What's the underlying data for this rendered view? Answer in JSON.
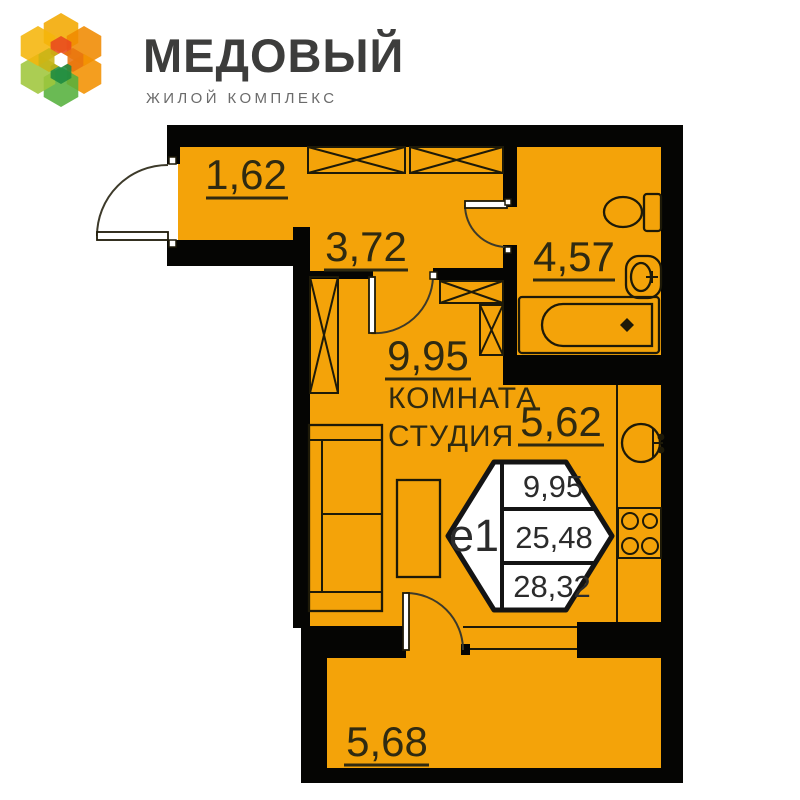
{
  "brand": {
    "name": "МЕДОВЫЙ",
    "tagline": "ЖИЛОЙ КОМПЛЕКС",
    "name_color": "#3D3D3C",
    "tagline_color": "#6B6B6B",
    "petal_colors": [
      "#F2A900",
      "#F08A00",
      "#F29100",
      "#55B03C",
      "#9FC63B",
      "#F5B50A",
      "#E8491F",
      "#E8740F",
      "#1D8A40",
      "#C8B415",
      "#FFFFFF"
    ]
  },
  "plan": {
    "colors": {
      "floor": "#F4A309",
      "walls": "#050503",
      "ink": "#2F2A11",
      "badge_fill": "#FFFFFF",
      "badge_stroke": "#141414"
    },
    "areas": {
      "entry": "1,62",
      "hallway": "3,72",
      "bathroom": "4,57",
      "room": "9,95",
      "kitchen": "5,62",
      "balcony": "5,68"
    },
    "room_label": {
      "line1": "КОМНАТА",
      "line2": "СТУДИЯ"
    },
    "badge": {
      "unit_type": "е1",
      "living_area": "9,95",
      "apartment_area": "25,48",
      "total_area": "28,32"
    }
  }
}
